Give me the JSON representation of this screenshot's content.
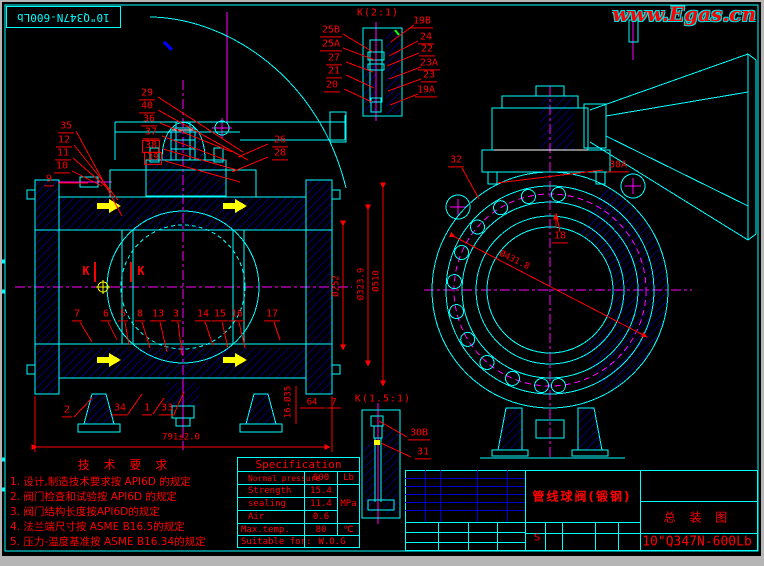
{
  "frame": {
    "corner_tag": "10\"Q347N-600Lb"
  },
  "watermark": {
    "text": "www.Egas.cn"
  },
  "details": {
    "k2_title": "K(2:1)",
    "k15_title": "K(1.5:1)",
    "section_mark": "K"
  },
  "tech": {
    "title": "技 术 要 求",
    "items": [
      "1. 设计,制造技术要求按 API6D 的规定",
      "2. 阀门检查和试验按 API6D 的规定",
      "3. 阀门结构长度按API6D的规定",
      "4. 法兰端尺寸按 ASME B16.5的规定",
      "5. 压力-温度基准按 ASME B16.34的规定"
    ]
  },
  "spec": {
    "title": "Specification",
    "rows": [
      {
        "label": "Normal pressure",
        "value": "600",
        "unit": "Lb"
      },
      {
        "label": "Strength",
        "value": "15.4",
        "unit": "MPa"
      },
      {
        "label": "sealing",
        "value": "11.4"
      },
      {
        "label": "Air",
        "value": "0.6"
      },
      {
        "label": "Max.temp.",
        "value": "80",
        "unit": "℃"
      }
    ],
    "footer_label": "Suitable for:",
    "footer_value": "W.O.G"
  },
  "title_block": {
    "product": "管线球阀(锻钢)",
    "drawing_type": "总 装 图",
    "model": "10\"Q347N-600Lb",
    "cell_s": "S"
  },
  "callouts": [
    {
      "t": "29",
      "x": 147,
      "y": 95
    },
    {
      "t": "40",
      "x": 147,
      "y": 108
    },
    {
      "t": "36",
      "x": 149,
      "y": 121
    },
    {
      "t": "37",
      "x": 151,
      "y": 134
    },
    {
      "t": "38",
      "x": 151,
      "y": 147,
      "box": true
    },
    {
      "t": "39",
      "x": 153,
      "y": 159,
      "box": true
    },
    {
      "t": "35",
      "x": 66,
      "y": 128
    },
    {
      "t": "12",
      "x": 64,
      "y": 142
    },
    {
      "t": "11",
      "x": 63,
      "y": 155
    },
    {
      "t": "10",
      "x": 62,
      "y": 168
    },
    {
      "t": "9",
      "x": 49,
      "y": 181
    },
    {
      "t": "26",
      "x": 280,
      "y": 142
    },
    {
      "t": "28",
      "x": 280,
      "y": 155
    },
    {
      "t": "7",
      "x": 77,
      "y": 316
    },
    {
      "t": "6",
      "x": 106,
      "y": 316
    },
    {
      "t": "5",
      "x": 123,
      "y": 316
    },
    {
      "t": "8",
      "x": 140,
      "y": 316
    },
    {
      "t": "13",
      "x": 158,
      "y": 316
    },
    {
      "t": "3",
      "x": 176,
      "y": 316
    },
    {
      "t": "14",
      "x": 203,
      "y": 316
    },
    {
      "t": "15",
      "x": 220,
      "y": 316
    },
    {
      "t": "16",
      "x": 237,
      "y": 316
    },
    {
      "t": "17",
      "x": 272,
      "y": 316
    },
    {
      "t": "2",
      "x": 67,
      "y": 412
    },
    {
      "t": "34",
      "x": 120,
      "y": 410
    },
    {
      "t": "1",
      "x": 147,
      "y": 410
    },
    {
      "t": "33",
      "x": 167,
      "y": 410
    },
    {
      "t": "32",
      "x": 456,
      "y": 162
    },
    {
      "t": "30A",
      "x": 618,
      "y": 167
    },
    {
      "t": "18",
      "x": 560,
      "y": 238
    },
    {
      "t": "25B",
      "x": 331,
      "y": 32
    },
    {
      "t": "25A",
      "x": 331,
      "y": 46
    },
    {
      "t": "27",
      "x": 334,
      "y": 60
    },
    {
      "t": "21",
      "x": 334,
      "y": 73
    },
    {
      "t": "20",
      "x": 332,
      "y": 87
    },
    {
      "t": "19B",
      "x": 422,
      "y": 23
    },
    {
      "t": "24",
      "x": 426,
      "y": 39
    },
    {
      "t": "22",
      "x": 427,
      "y": 51
    },
    {
      "t": "23A",
      "x": 429,
      "y": 65
    },
    {
      "t": "23",
      "x": 429,
      "y": 77
    },
    {
      "t": "19A",
      "x": 426,
      "y": 92
    },
    {
      "t": "30B",
      "x": 419,
      "y": 435
    },
    {
      "t": "31",
      "x": 423,
      "y": 454
    }
  ],
  "dimensions": [
    {
      "t": "791±2.0",
      "x": 181,
      "y": 438
    },
    {
      "t": "Ø252",
      "x": 337,
      "y": 286,
      "r": -90
    },
    {
      "t": "Ø323.9",
      "x": 362,
      "y": 284,
      "r": -90
    },
    {
      "t": "Ø510",
      "x": 377,
      "y": 281,
      "r": -90
    },
    {
      "t": "16-Ø35",
      "x": 289,
      "y": 402,
      "r": -90
    },
    {
      "t": "64",
      "x": 312,
      "y": 403
    },
    {
      "t": "7",
      "x": 334,
      "y": 403
    },
    {
      "t": "Ø431.8",
      "x": 514,
      "y": 261,
      "r": 26
    }
  ],
  "colors": {
    "linework": "#00ffff",
    "hatch": "#0000dd",
    "centerline": "#ff00ff",
    "annotation": "#ff0000",
    "accent": "#ffff00",
    "background": "#000000"
  }
}
